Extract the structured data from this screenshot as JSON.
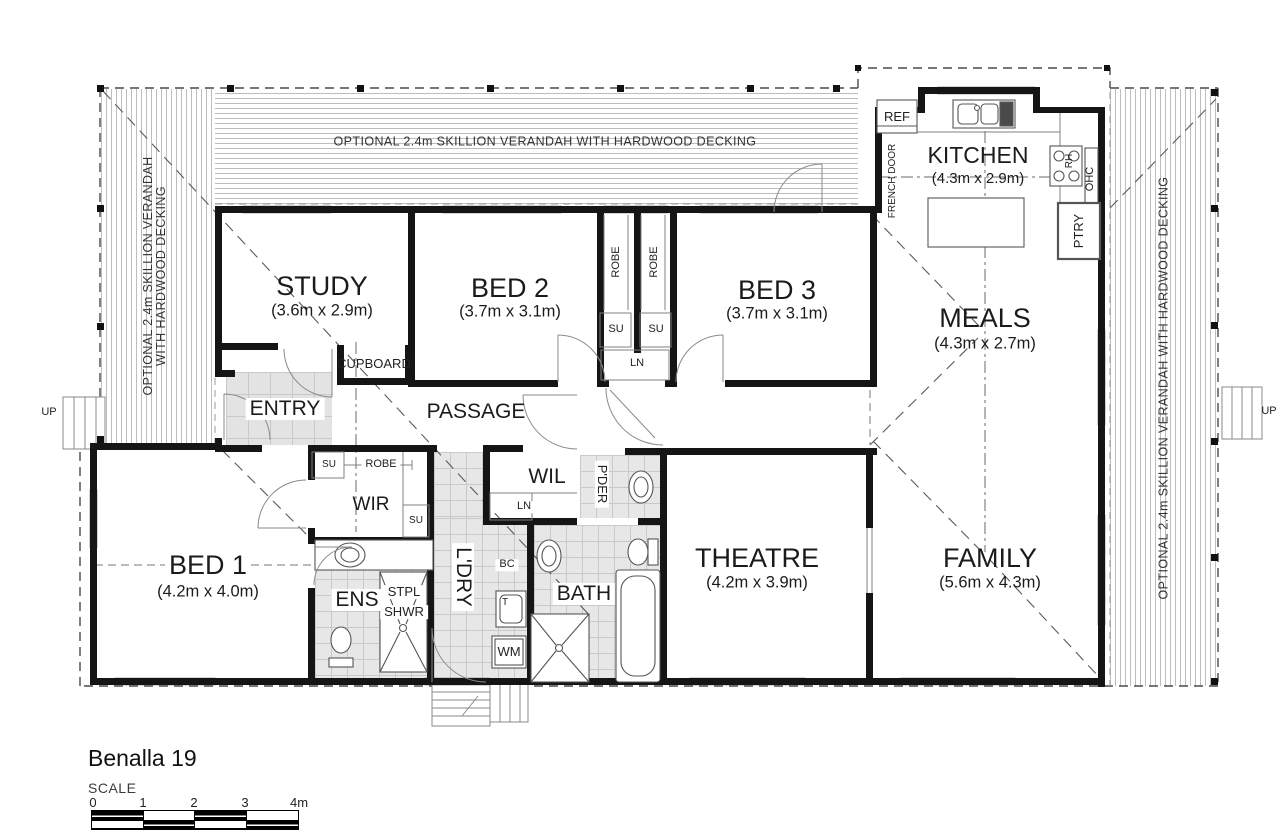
{
  "footer": {
    "title": "Benalla 19",
    "scale_label": "SCALE",
    "ticks": [
      "0",
      "1",
      "2",
      "3",
      "4m"
    ]
  },
  "verandah": {
    "top": "OPTIONAL 2.4m SKILLION VERANDAH WITH HARDWOOD DECKING",
    "left1": "OPTIONAL 2.4m SKILLION VERANDAH",
    "left2": "WITH HARDWOOD DECKING",
    "right": "OPTIONAL 2.4m SKILLION VERANDAH WITH HARDWOOD DECKING"
  },
  "rooms": {
    "study": {
      "name": "STUDY",
      "dims": "(3.6m x 2.9m)"
    },
    "bed2": {
      "name": "BED 2",
      "dims": "(3.7m x 3.1m)"
    },
    "bed3": {
      "name": "BED 3",
      "dims": "(3.7m x 3.1m)"
    },
    "kitchen": {
      "name": "KITCHEN",
      "dims": "(4.3m x 2.9m)"
    },
    "meals": {
      "name": "MEALS",
      "dims": "(4.3m x 2.7m)"
    },
    "bed1": {
      "name": "BED 1",
      "dims": "(4.2m x 4.0m)"
    },
    "theatre": {
      "name": "THEATRE",
      "dims": "(4.2m x 3.9m)"
    },
    "family": {
      "name": "FAMILY",
      "dims": "(5.6m x 4.3m)"
    },
    "entry": "ENTRY",
    "passage": "PASSAGE",
    "cupboard": "CUPBOARD",
    "wir": "WIR",
    "wil": "WIL",
    "ens": "ENS",
    "bath": "BATH",
    "laundry": "L'DRY",
    "powder": "P'DER"
  },
  "labels": {
    "ref": "REF",
    "french_door": "FRENCH DOOR",
    "ohc": "OHC",
    "rh": "RH",
    "ptry": "PTRY",
    "robe": "ROBE",
    "su": "SU",
    "ln": "LN",
    "stpl": "STPL",
    "shwr": "SHWR",
    "bc": "BC",
    "tub": "T",
    "wm": "WM",
    "up": "UP"
  }
}
